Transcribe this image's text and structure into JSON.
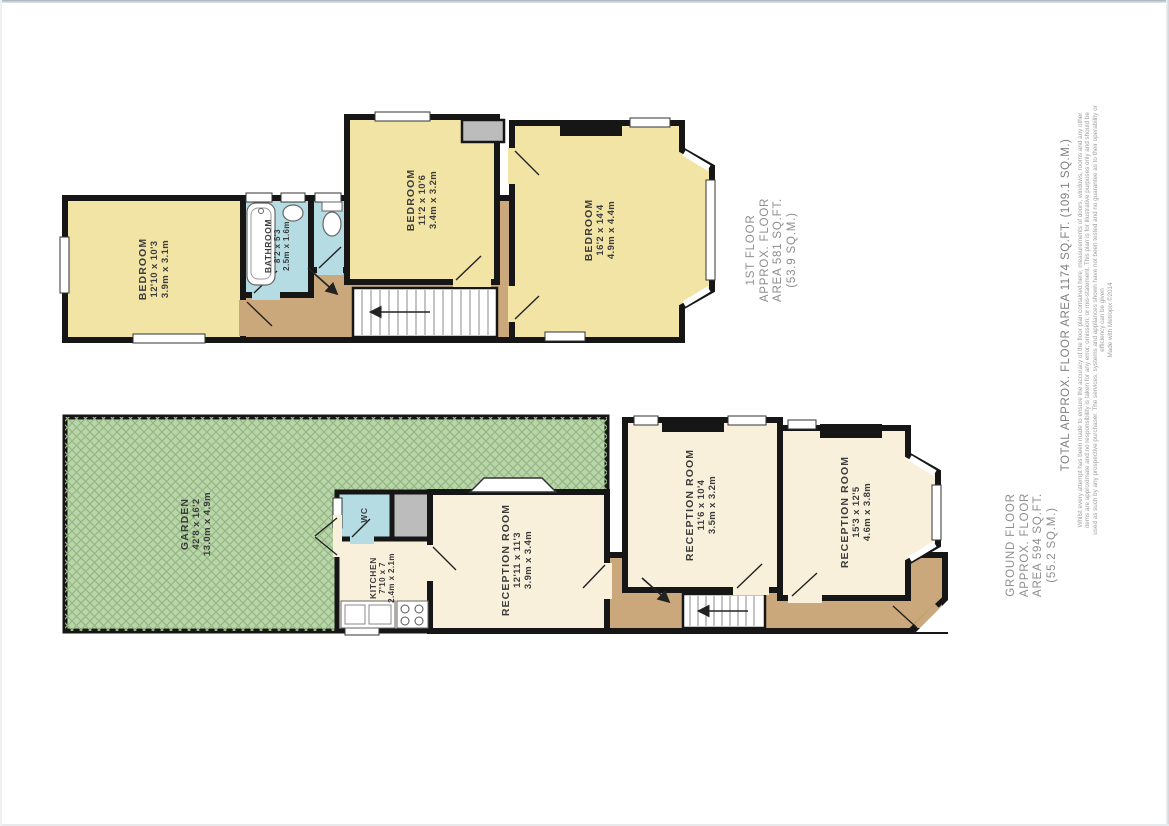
{
  "document": {
    "type": "floorplan"
  },
  "colors": {
    "wall": "#161616",
    "bedroom_yellow": "#f2e4a4",
    "reception_cream": "#f9f0dc",
    "wet_room_blue": "#b4dce2",
    "hall_tan": "#cba87b",
    "garden_green": "#bad4ab",
    "garden_hatch": "#92b97f",
    "void_gray": "#bcbcbc"
  },
  "first_floor": {
    "label": {
      "lines": [
        "1ST FLOOR",
        "APPROX. FLOOR",
        "AREA 581 SQ.FT.",
        "(53.9 SQ.M.)"
      ]
    },
    "rooms": {
      "bedroom1": {
        "name": "BEDROOM",
        "imperial": "12'10 x 10'3",
        "metric": "3.9m x 3.1m"
      },
      "bathroom": {
        "name": "BATHROOM",
        "imperial": "8'2 x 5'3",
        "metric": "2.5m x 1.6m"
      },
      "bedroom2": {
        "name": "BEDROOM",
        "imperial": "11'2 x 10'6",
        "metric": "3.4m x 3.2m"
      },
      "bedroom3": {
        "name": "BEDROOM",
        "imperial": "16'2 x 14'4",
        "metric": "4.9m x 4.4m"
      }
    }
  },
  "ground_floor": {
    "label": {
      "lines": [
        "GROUND FLOOR",
        "APPROX. FLOOR",
        "AREA 594 SQ.FT.",
        "(55.2 SQ.M.)"
      ]
    },
    "rooms": {
      "garden": {
        "name": "GARDEN",
        "imperial": "42'8 x 16'2",
        "metric": "13.0m x 4.9m"
      },
      "wc": {
        "name": "WC"
      },
      "kitchen": {
        "name": "KITCHEN",
        "imperial": "7'10 x 7",
        "metric": "2.4m x 2.1m"
      },
      "reception1": {
        "name": "RECEPTION ROOM",
        "imperial": "12'11 x 11'3",
        "metric": "3.9m x 3.4m"
      },
      "reception2": {
        "name": "RECEPTION ROOM",
        "imperial": "11'6 x 10'4",
        "metric": "3.5m x 3.2m"
      },
      "reception3": {
        "name": "RECEPTION ROOM",
        "imperial": "15'3 x 12'5",
        "metric": "4.6m x 3.8m"
      }
    }
  },
  "footer": {
    "total": "TOTAL APPROX. FLOOR AREA 1174 SQ.FT. (109.1 SQ.M.)",
    "disclaimer": "Whilst every attempt has been made to ensure the accuracy of the floor plan contained here, measurements of doors, windows, rooms and any other items are approximate and no responsibility is taken for any error, omission, or mis-statement. This plan is for illustrative purposes only and should be used as such by any prospective purchaser. The services, systems and appliances shown have not been tested and no guarantee as to their operability or efficiency can be given",
    "credit": "Made with Metropix ©2014"
  }
}
